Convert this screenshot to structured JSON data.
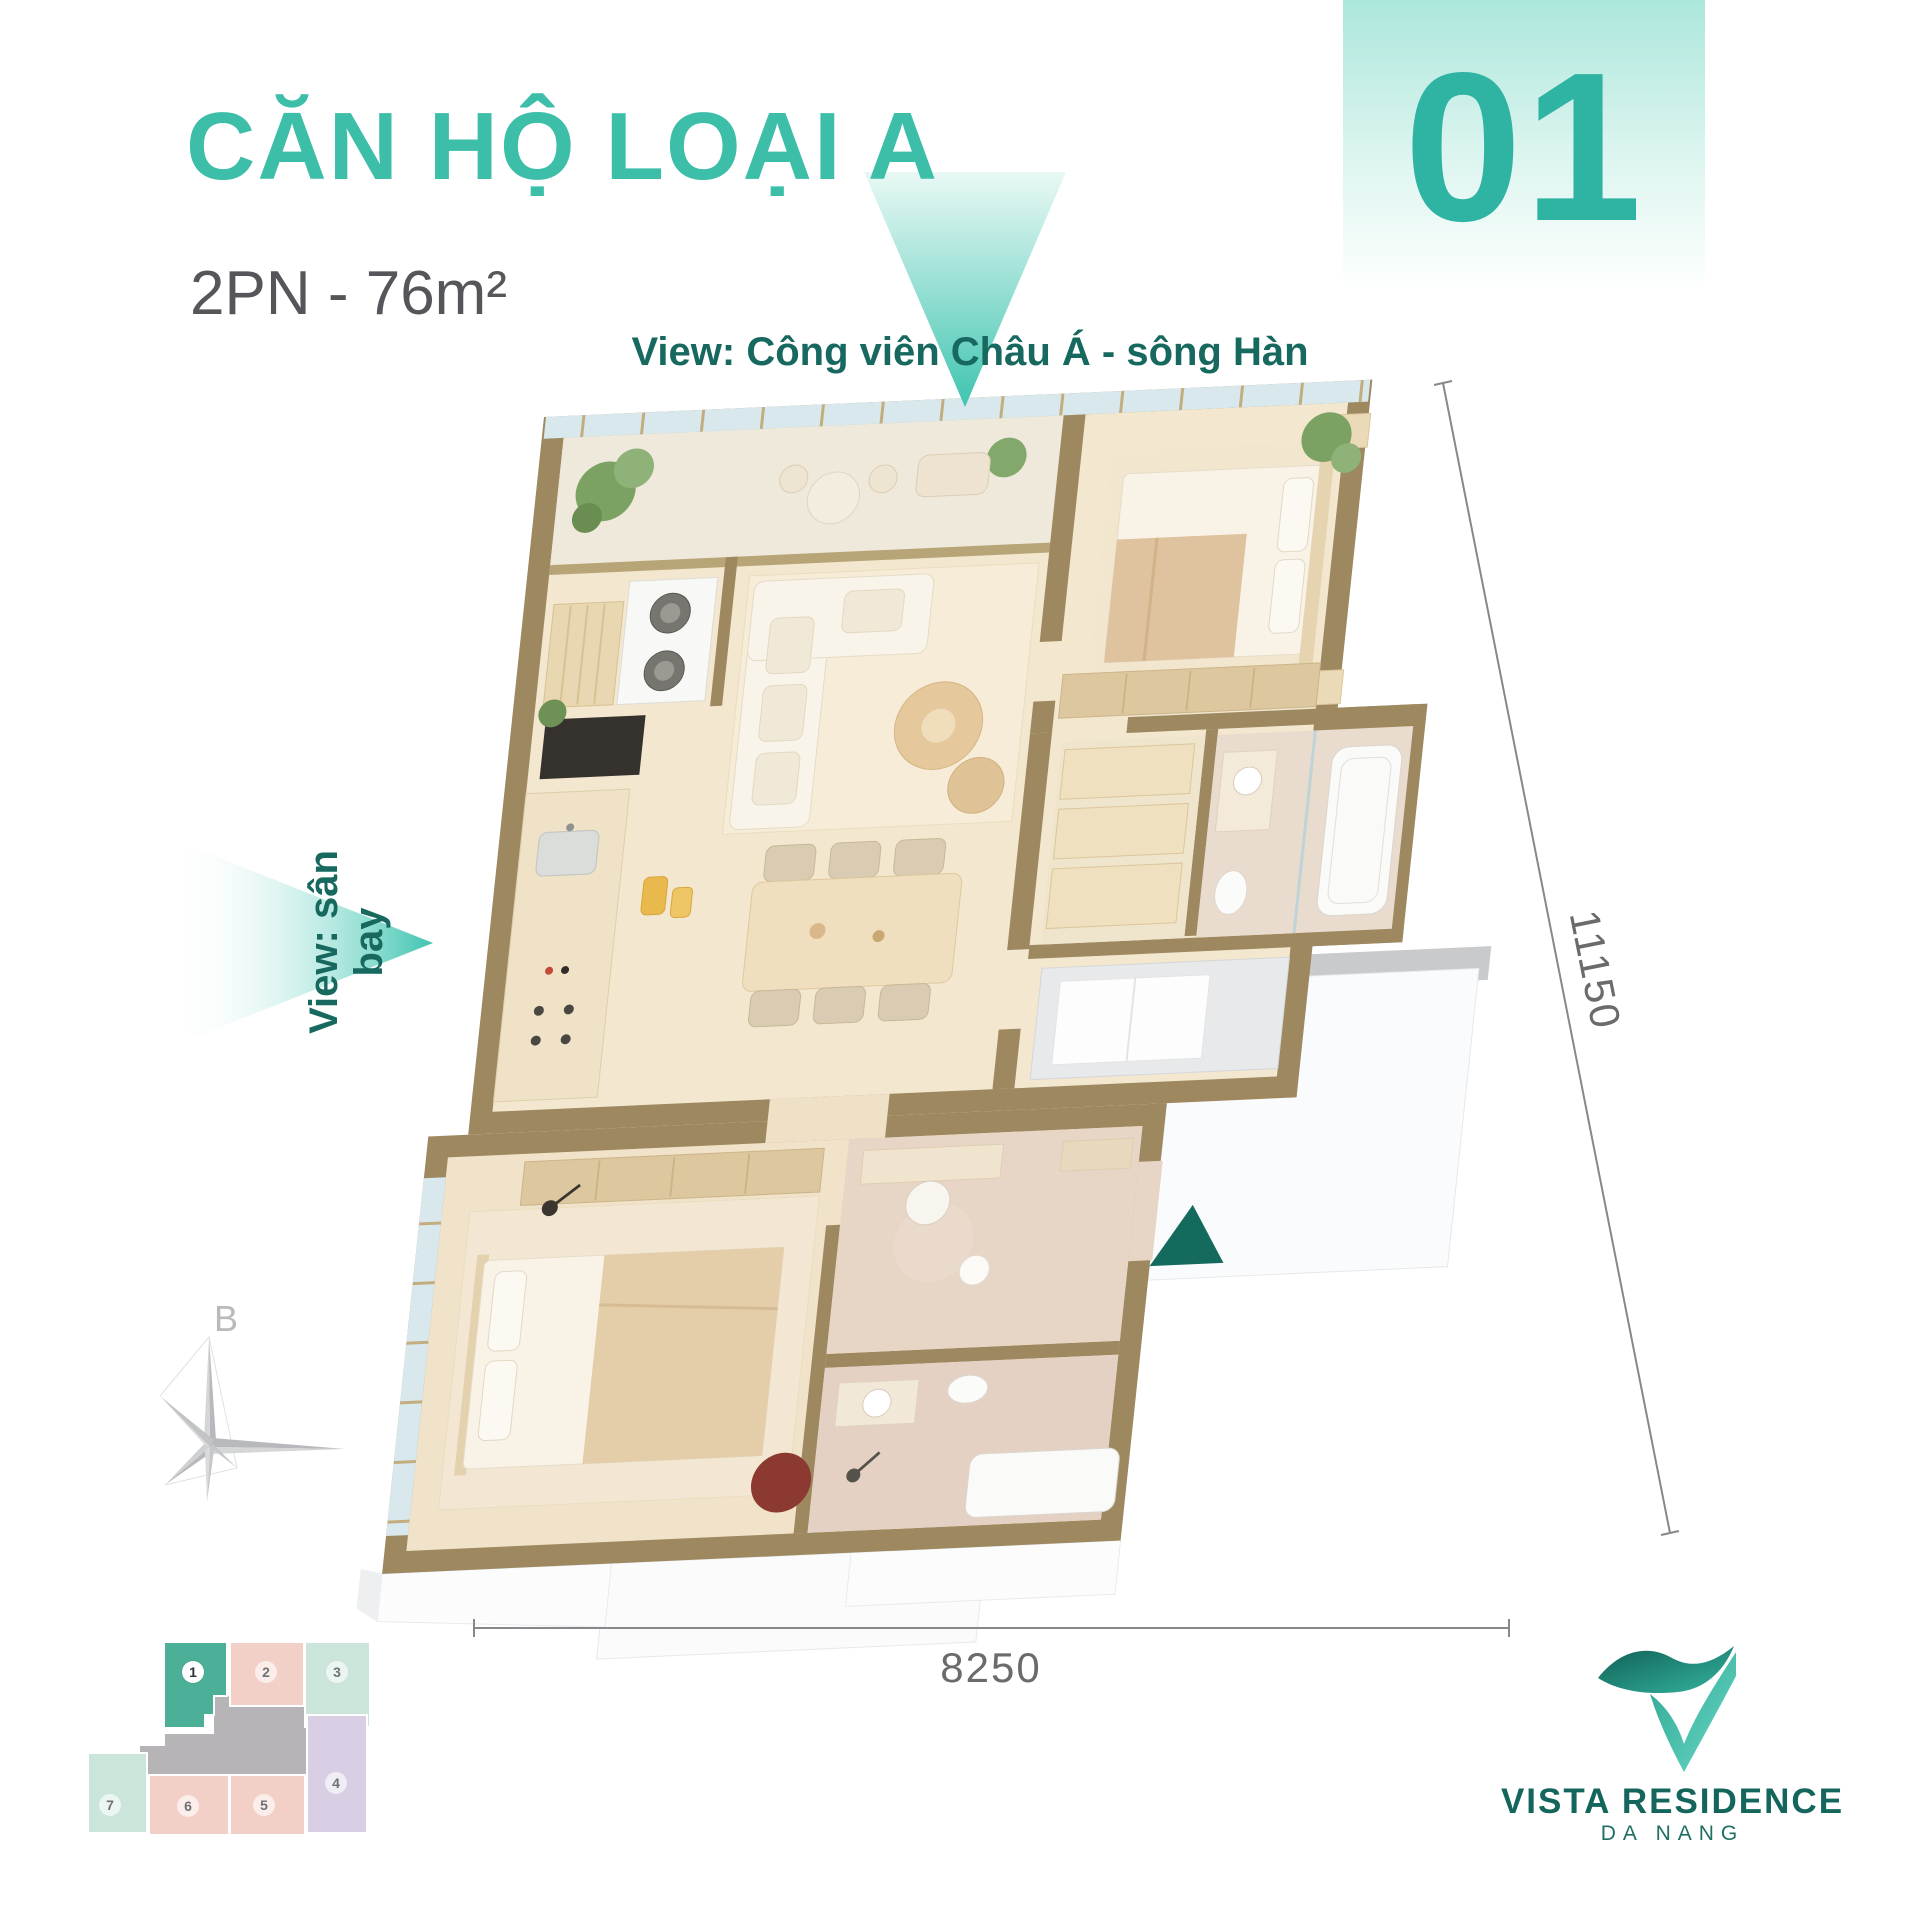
{
  "header": {
    "title": "CĂN HỘ LOẠI A",
    "subtitle": "2PN - 76m²",
    "unit_number": "01"
  },
  "views": {
    "top": "View: Công viên Châu Á - sông Hàn",
    "left": "View: sân bay"
  },
  "dimensions": {
    "depth": "11150",
    "width": "8250"
  },
  "compass": {
    "north_label": "B"
  },
  "key_plan": {
    "units": [
      {
        "number": "1",
        "highlighted": true,
        "color": "#4BB097"
      },
      {
        "number": "2",
        "highlighted": false,
        "color": "#F2D0C8"
      },
      {
        "number": "3",
        "highlighted": false,
        "color": "#CBE5DB"
      },
      {
        "number": "4",
        "highlighted": false,
        "color": "#D9CFE4"
      },
      {
        "number": "5",
        "highlighted": false,
        "color": "#F2D0C8"
      },
      {
        "number": "6",
        "highlighted": false,
        "color": "#F2D0C8"
      },
      {
        "number": "7",
        "highlighted": false,
        "color": "#CBE5DB"
      }
    ],
    "corridor_color": "#B6B4B7"
  },
  "logo": {
    "name": "VISTA RESIDENCE",
    "location": "DA NANG"
  },
  "colors": {
    "accent_teal": "#3CBEA9",
    "dark_teal": "#17695F",
    "entry_marker": "#156A5E",
    "wall_tan": "#9D8860",
    "floor_cream": "#F3E7CF",
    "dim_gray": "#6A6B6D"
  }
}
